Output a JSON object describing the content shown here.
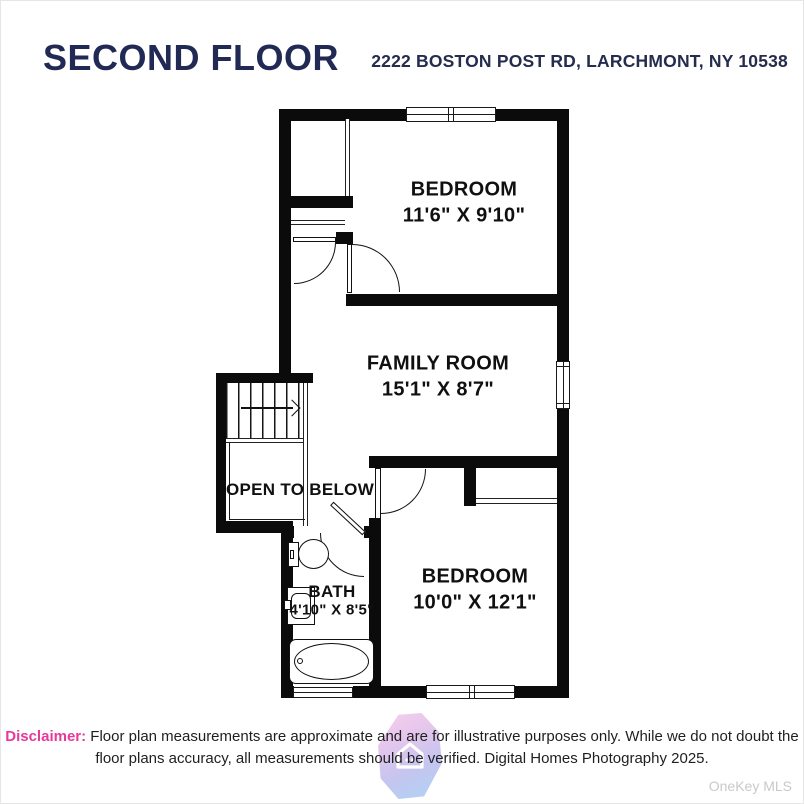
{
  "header": {
    "title": "SECOND FLOOR",
    "address": "2222 BOSTON POST RD, LARCHMONT, NY 10538"
  },
  "rooms": [
    {
      "id": "bedroom-top",
      "name": "BEDROOM",
      "dims": "11'6\" X 9'10\""
    },
    {
      "id": "family-room",
      "name": "FAMILY ROOM",
      "dims": "15'1\" X 8'7\""
    },
    {
      "id": "open-to-below",
      "name": "OPEN TO BELOW",
      "dims": ""
    },
    {
      "id": "bath",
      "name": "BATH",
      "dims": "4'10\" X 8'5\""
    },
    {
      "id": "bedroom-bottom",
      "name": "BEDROOM",
      "dims": "10'0\" X 12'1\""
    }
  ],
  "footer": {
    "disclaimer_label": "Disclaimer:",
    "disclaimer_line1": "Floor plan measurements are approximate and are for illustrative purposes only. While we do not doubt the",
    "disclaimer_line2": "floor plans accuracy, all measurements should be verified. Digital Homes Photography 2025.",
    "watermark": "OneKey MLS"
  },
  "colors": {
    "title_navy": "#202a54",
    "accent_pink": "#e6399b",
    "wall_black": "#0b0b0b",
    "watermark_gray": "#c9c9c9",
    "logo_pink": "#ef9fda",
    "logo_blue": "#5fa8e8"
  }
}
